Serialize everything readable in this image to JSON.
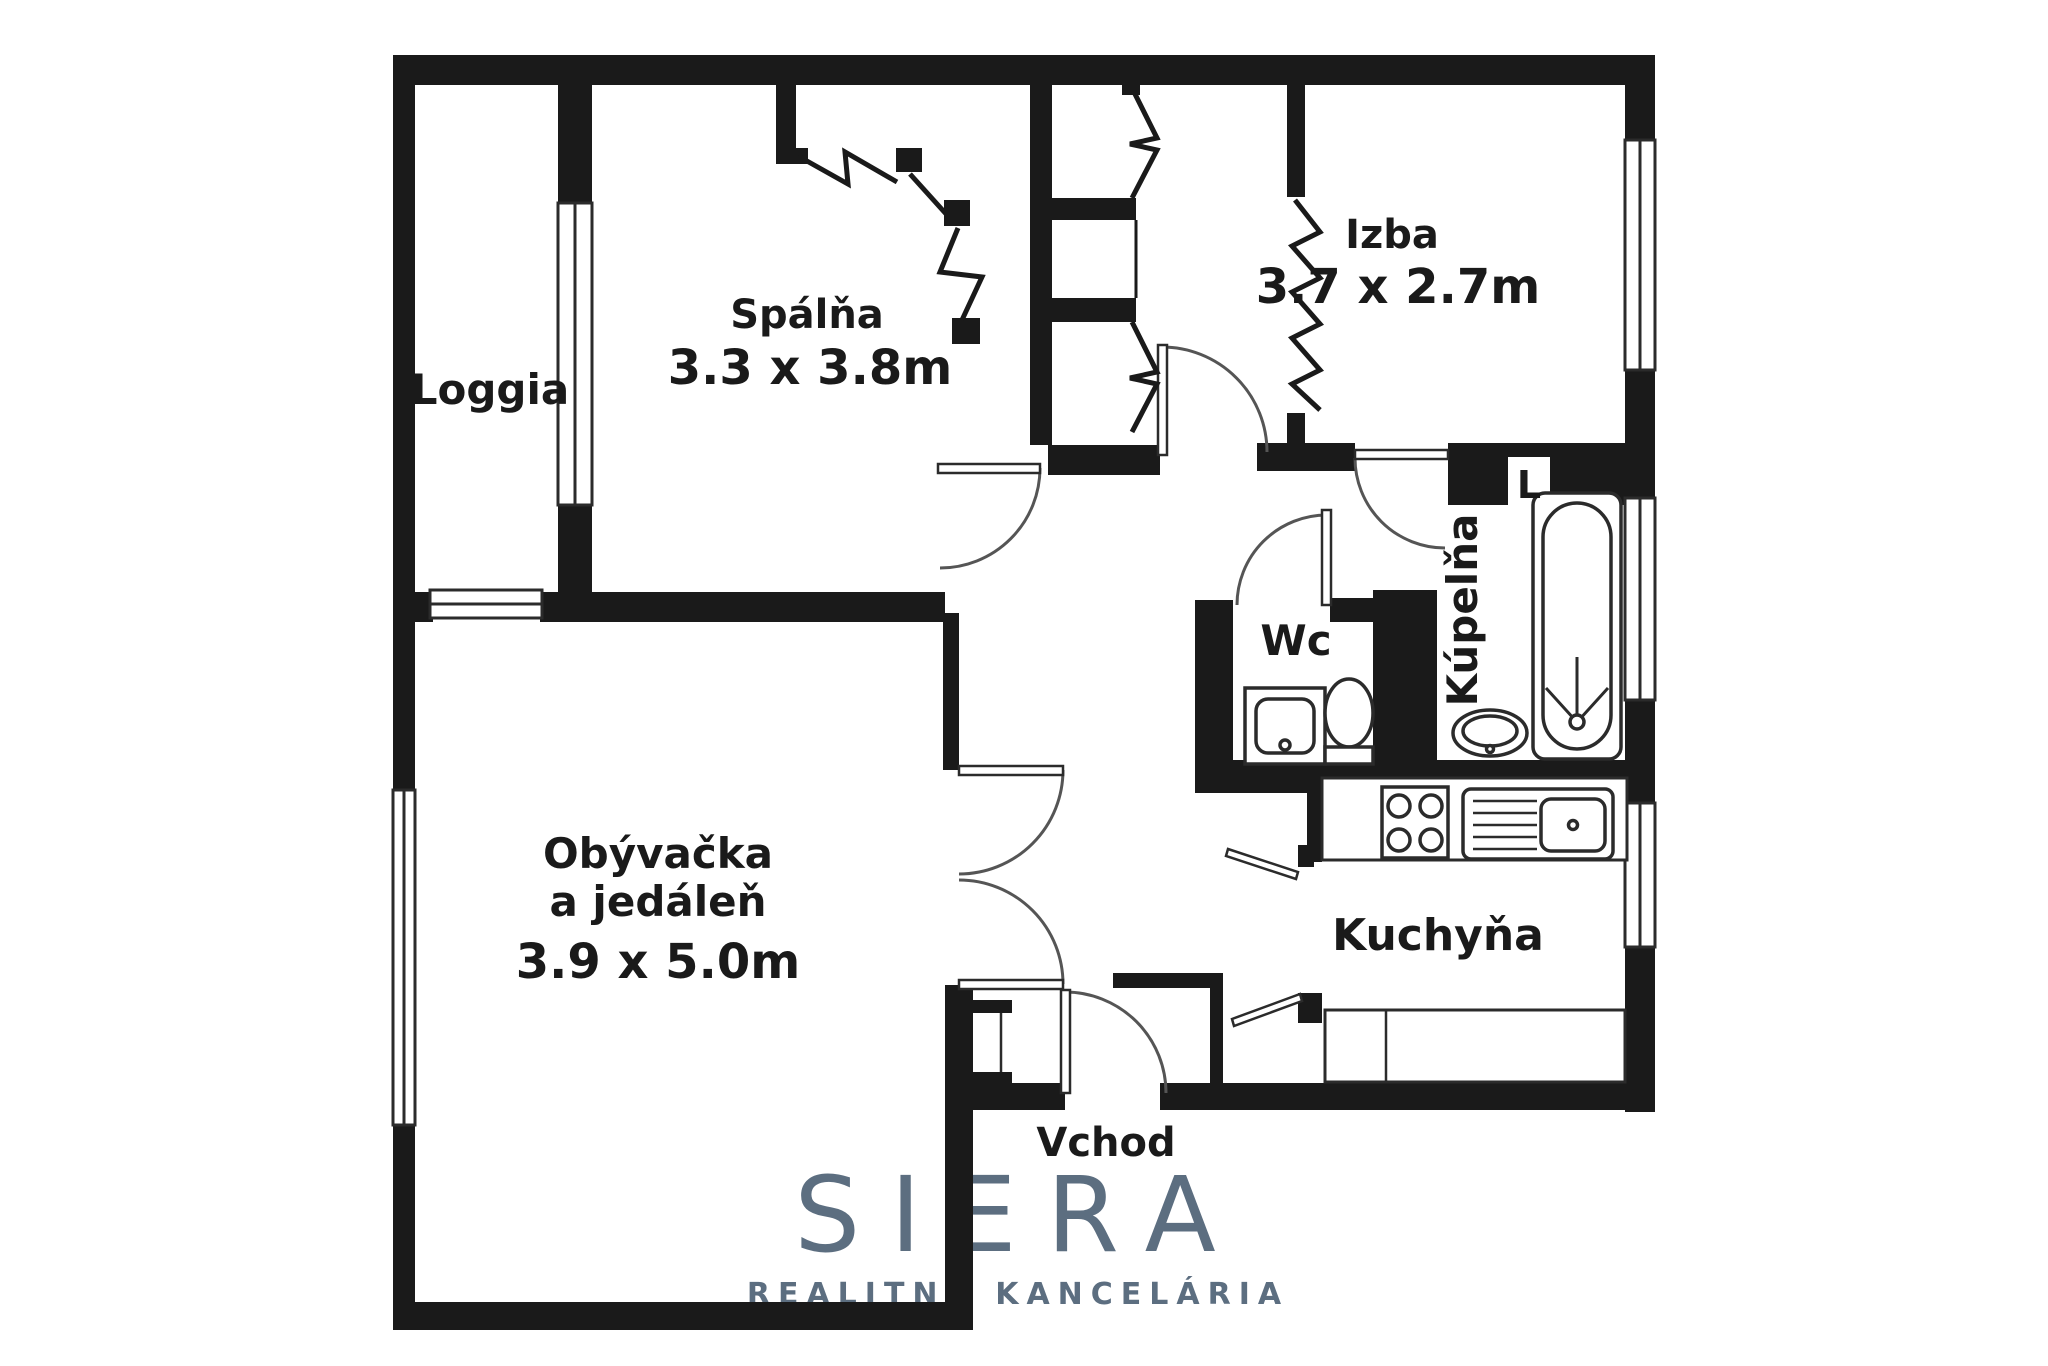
{
  "page": {
    "background": "#ffffff"
  },
  "brand": {
    "name": "SIERA",
    "tagline": "REALITNÁ KANCELÁRIA",
    "color": "#5c6e80"
  },
  "plan": {
    "wall_color": "#1a1a1a",
    "entrance_label": "Vchod",
    "pantry_label": "L",
    "rooms": [
      {
        "id": "loggia",
        "name": "Loggia",
        "dims": ""
      },
      {
        "id": "spalna",
        "name": "Spálňa",
        "dims": "3.3 x 3.8m"
      },
      {
        "id": "izba",
        "name": "Izba",
        "dims": "3.7 x 2.7m"
      },
      {
        "id": "obyvacka-jedalen",
        "name_line1": "Obývačka",
        "name_line2": "a jedáleň",
        "dims": "3.9 x 5.0m"
      },
      {
        "id": "wc",
        "name": "Wc",
        "dims": ""
      },
      {
        "id": "kupelna",
        "name": "Kúpelňa",
        "dims": ""
      },
      {
        "id": "kuchyna",
        "name": "Kuchyňa",
        "dims": ""
      }
    ],
    "fixture_icons": [
      "bathtub-icon",
      "washbasin-icon",
      "toilet-icon",
      "stove-icon",
      "kitchen-sink-icon",
      "window-icon",
      "door-arc-icon",
      "wardrobe-folding-door-icon"
    ]
  }
}
